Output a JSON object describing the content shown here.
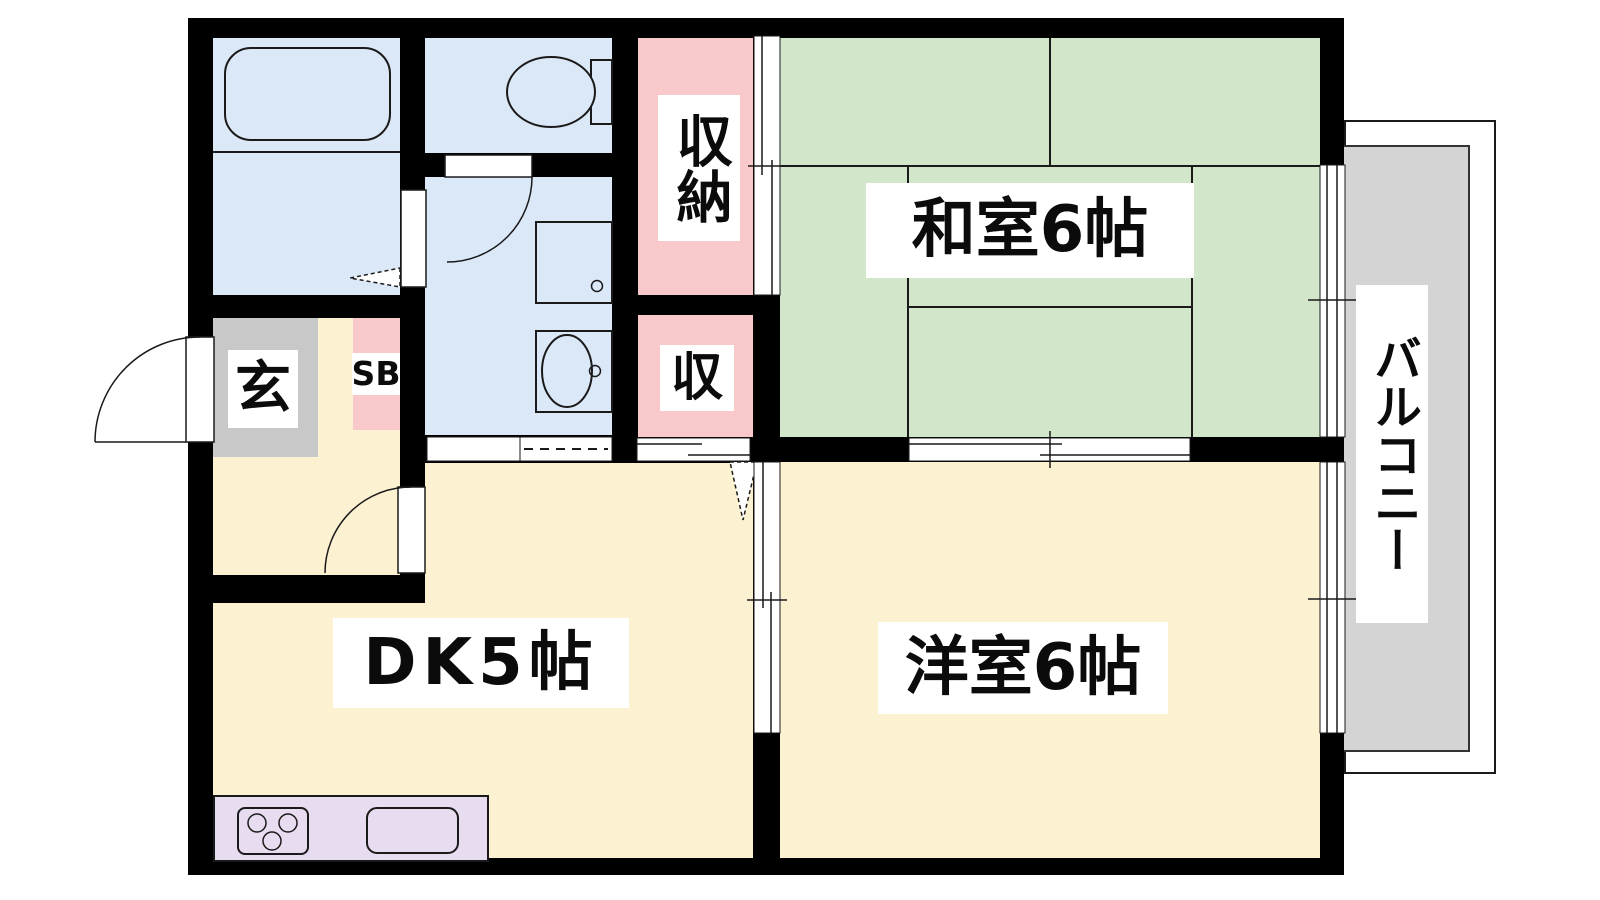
{
  "plan": {
    "labels": {
      "washitsu": "和室6帖",
      "youshitsu": "洋室6帖",
      "dk": "DK5帖",
      "balcony": "バルコニー",
      "closet_main": "収納",
      "closet_small": "収",
      "entrance": "玄",
      "shoebox": "SB"
    },
    "colors": {
      "wall": "#000000",
      "line": "#1a1a1a",
      "wet_room": "#dbe8f8",
      "tatami_room": "#d2e6c9",
      "western_room": "#fcf1d1",
      "closet": "#f9c8cb",
      "entrance_floor": "#c8c8c8",
      "balcony_floor": "#d4d4d4",
      "kitchen_counter": "#e7dcf0",
      "label_background": "#ffffff"
    },
    "fixtures": [
      "bathtub",
      "toilet",
      "washing-machine-pan",
      "wash-basin",
      "gas-stove-3-burner",
      "kitchen-sink"
    ]
  }
}
